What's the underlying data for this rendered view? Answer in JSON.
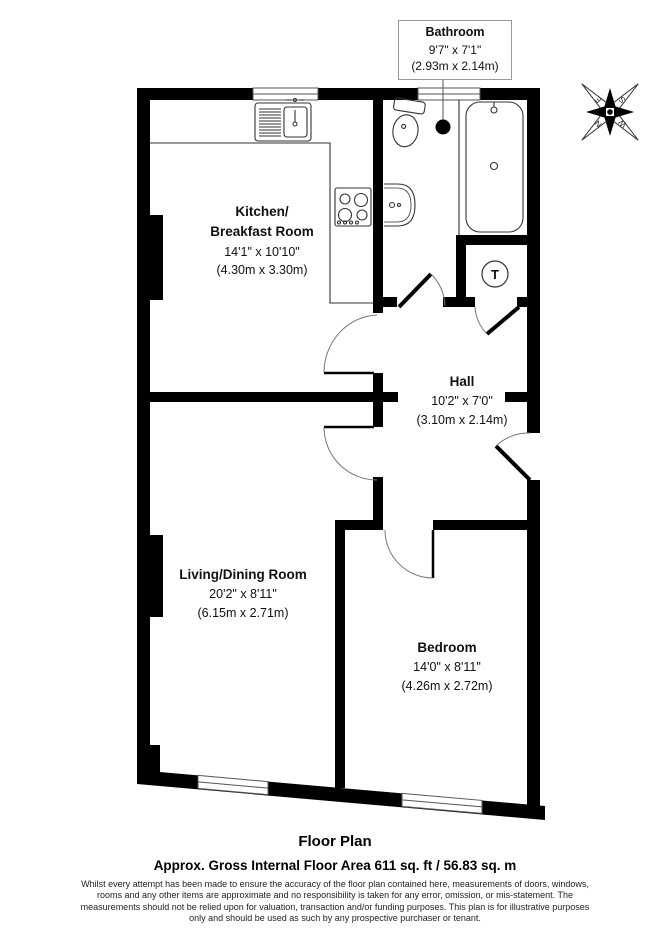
{
  "rooms": {
    "bathroom": {
      "name": "Bathroom",
      "imperial": "9'7\" x 7'1\"",
      "metric": "(2.93m x 2.14m)"
    },
    "kitchen": {
      "name_line1": "Kitchen/",
      "name_line2": "Breakfast Room",
      "imperial": "14'1\" x 10'10\"",
      "metric": "(4.30m x 3.30m)"
    },
    "hall": {
      "name": "Hall",
      "imperial": "10'2\" x 7'0\"",
      "metric": "(3.10m x 2.14m)"
    },
    "living": {
      "name": "Living/Dining Room",
      "imperial": "20'2\" x 8'11\"",
      "metric": "(6.15m x 2.71m)"
    },
    "bedroom": {
      "name": "Bedroom",
      "imperial": "14'0\" x 8'11\"",
      "metric": "(4.26m x 2.72m)"
    }
  },
  "symbols": {
    "tank_label": "T",
    "compass": {
      "north": "N",
      "east": "E",
      "south": "S",
      "west": "W"
    }
  },
  "footer": {
    "title": "Floor Plan",
    "area_line": "Approx. Gross Internal Floor Area 611 sq. ft / 56.83 sq. m",
    "disclaimer_lines": [
      "Whilst every attempt has been made to ensure the accuracy of the floor plan contained here, measurements of doors, windows,",
      "rooms and any other items are approximate and no responsibility is taken for any error, omission, or mis-statement. The",
      "measurements should not be relied upon for valuation, transaction and/or funding purposes. This plan is for illustrative purposes",
      "only and should be used as such by any prospective purchaser or tenant."
    ]
  },
  "colors": {
    "wall": "#000000",
    "fixture_line": "#333333",
    "text": "#111111"
  }
}
